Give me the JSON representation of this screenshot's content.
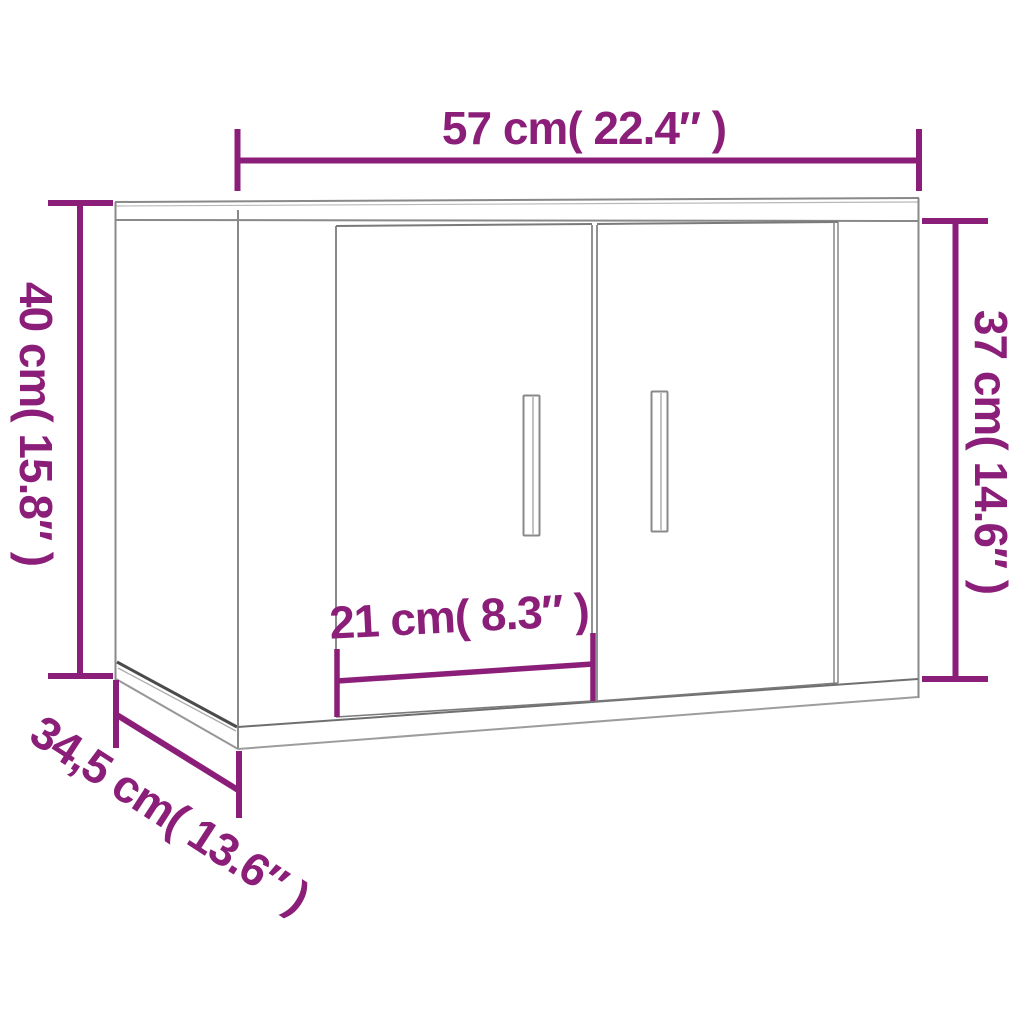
{
  "drawing": {
    "subject": "wall-mounted cabinet with two doors, 3d line drawing",
    "background_color": "#ffffff",
    "accent_color": "#8B1E78",
    "line_color": "#898989",
    "dark_line_color": "#4b4b4b"
  },
  "dimensions": {
    "width": {
      "label": "57 cm( 22.4″ )",
      "value_cm": 57,
      "value_in": 22.4
    },
    "height_left": {
      "label": "40 cm( 15.8″ )",
      "value_cm": 40,
      "value_in": 15.8
    },
    "height_right": {
      "label": "37 cm( 14.6″ )",
      "value_cm": 37,
      "value_in": 14.6
    },
    "door_width": {
      "label": "21 cm( 8.3″ )",
      "value_cm": 21,
      "value_in": 8.3
    },
    "depth": {
      "label": "34,5 cm( 13.6″ )",
      "value_cm": 34.5,
      "value_in": 13.6
    }
  }
}
